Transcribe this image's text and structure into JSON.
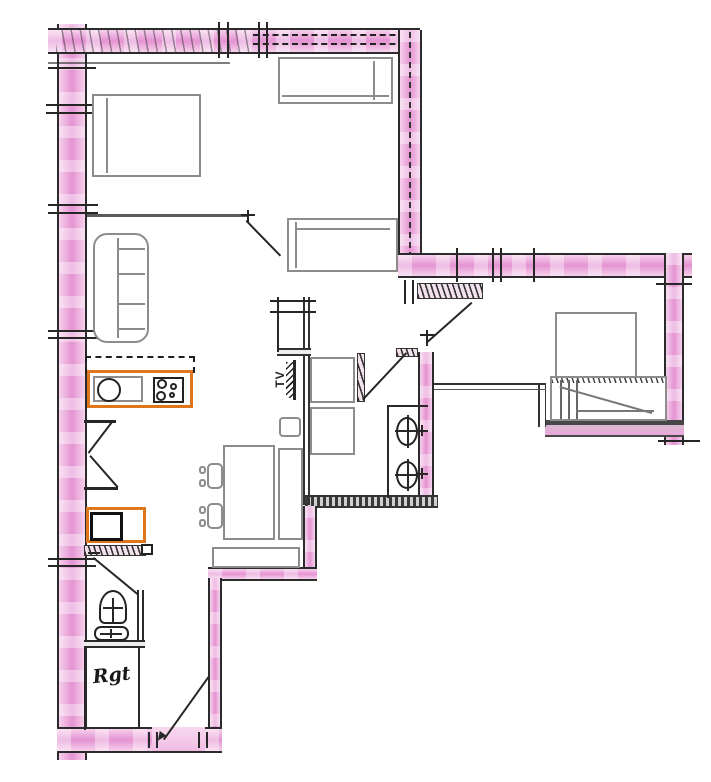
{
  "plan": {
    "description": "Hand-drawn scanned apartment floor plan with pink highlighted walls and orange highlighted kitchen appliances",
    "labels": {
      "tv": "TV",
      "storage": "Rgt"
    },
    "colors": {
      "wall_highlight_pink": "#eeaede",
      "appliance_highlight_orange": "#e0761c",
      "ink_line": "#282828",
      "furniture_line": "#8c8c8c",
      "paper": "#ffffff"
    },
    "items": [
      "double-bed",
      "single-bed-top",
      "sofa-bed",
      "three-seat-sofa",
      "kitchen-unit-with-sink",
      "hob-with-burners",
      "overhead-cupboard-dashed",
      "appliance-box",
      "dining-table",
      "dining-chair",
      "dining-chair",
      "side-counter",
      "stool",
      "bench",
      "shower-square",
      "washer-square",
      "vanity-with-two-basins",
      "toilet",
      "hand-basin",
      "bed-right-room",
      "stairs-band",
      "tv-wall-mount",
      "bifold-closet-doors",
      "storage-closet"
    ],
    "door_swings": 7
  }
}
